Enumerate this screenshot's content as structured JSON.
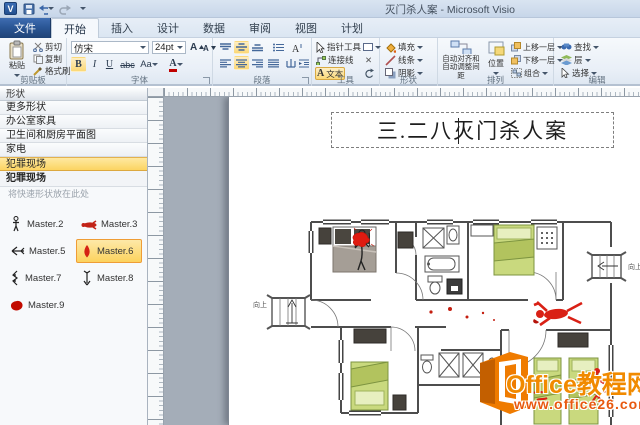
{
  "titlebar": {
    "visio_initial": "V",
    "title": "灭门杀人案 - Microsoft Visio"
  },
  "tabs": {
    "file": "文件",
    "items": [
      "开始",
      "插入",
      "设计",
      "数据",
      "审阅",
      "视图",
      "计划"
    ]
  },
  "ribbon": {
    "clipboard": {
      "group": "剪贴板",
      "paste": "粘贴",
      "cut": "剪切",
      "copy": "复制",
      "painter": "格式刷"
    },
    "font": {
      "group": "字体",
      "family": "仿宋",
      "size": "24pt",
      "bold": "B",
      "italic": "I",
      "underline": "U",
      "strike": "abc",
      "case_btn": "Aa",
      "color_btn": "A",
      "grow": "A",
      "shrink": "A"
    },
    "paragraph": {
      "group": "段落"
    },
    "tools": {
      "group": "工具",
      "pointer": "指针工具",
      "connector": "连接线",
      "text_a": "A",
      "text_btn": "文本",
      "x_glyph": "✕"
    },
    "shape": {
      "group": "形状",
      "fill": "填充",
      "line": "线条",
      "shadow": "阴影"
    },
    "arrange": {
      "group": "排列",
      "align_line1": "自动对齐和",
      "align_line2": "自动调整间距",
      "position": "位置",
      "forward": "上移一层",
      "backward": "下移一层",
      "group_btn": "组合"
    },
    "editing": {
      "group": "编辑",
      "find": "查找",
      "layers": "层",
      "select": "选择"
    }
  },
  "shapes_panel": {
    "header": "形状",
    "stencils": [
      "更多形状",
      "办公室家具",
      "卫生间和厨房平面图",
      "家电",
      "犯罪现场"
    ],
    "selected_stencil": "犯罪现场",
    "section_title": "犯罪现场",
    "hint": "将快速形状放在此处",
    "masters": [
      {
        "label": "Master.2",
        "icon": "standing-figure-icon"
      },
      {
        "label": "Master.3",
        "icon": "lying-body-icon"
      },
      {
        "label": "Master.5",
        "icon": "arrow-left-icon"
      },
      {
        "label": "Master.6",
        "icon": "blood-drop-icon"
      },
      {
        "label": "Master.7",
        "icon": "zigzag-icon"
      },
      {
        "label": "Master.8",
        "icon": "arrow-down-icon"
      },
      {
        "label": "Master.9",
        "icon": "blood-pool-icon"
      }
    ],
    "selected_master": "Master.6"
  },
  "canvas": {
    "title": "三.二八灭门杀人案",
    "up_label": "向上"
  },
  "watermark": {
    "line1": "Office教程网",
    "line2": "www.office26.com"
  },
  "colors": {
    "selection_yellow": "#fcd96c",
    "blood_red": "#d6170e",
    "bed_green": "#c9d97e",
    "furniture_dark": "#46423c",
    "watermark_orange": "#ef7b00",
    "file_tab_blue": "#2b5796",
    "pasteboard_gray": "#a4adb8"
  }
}
